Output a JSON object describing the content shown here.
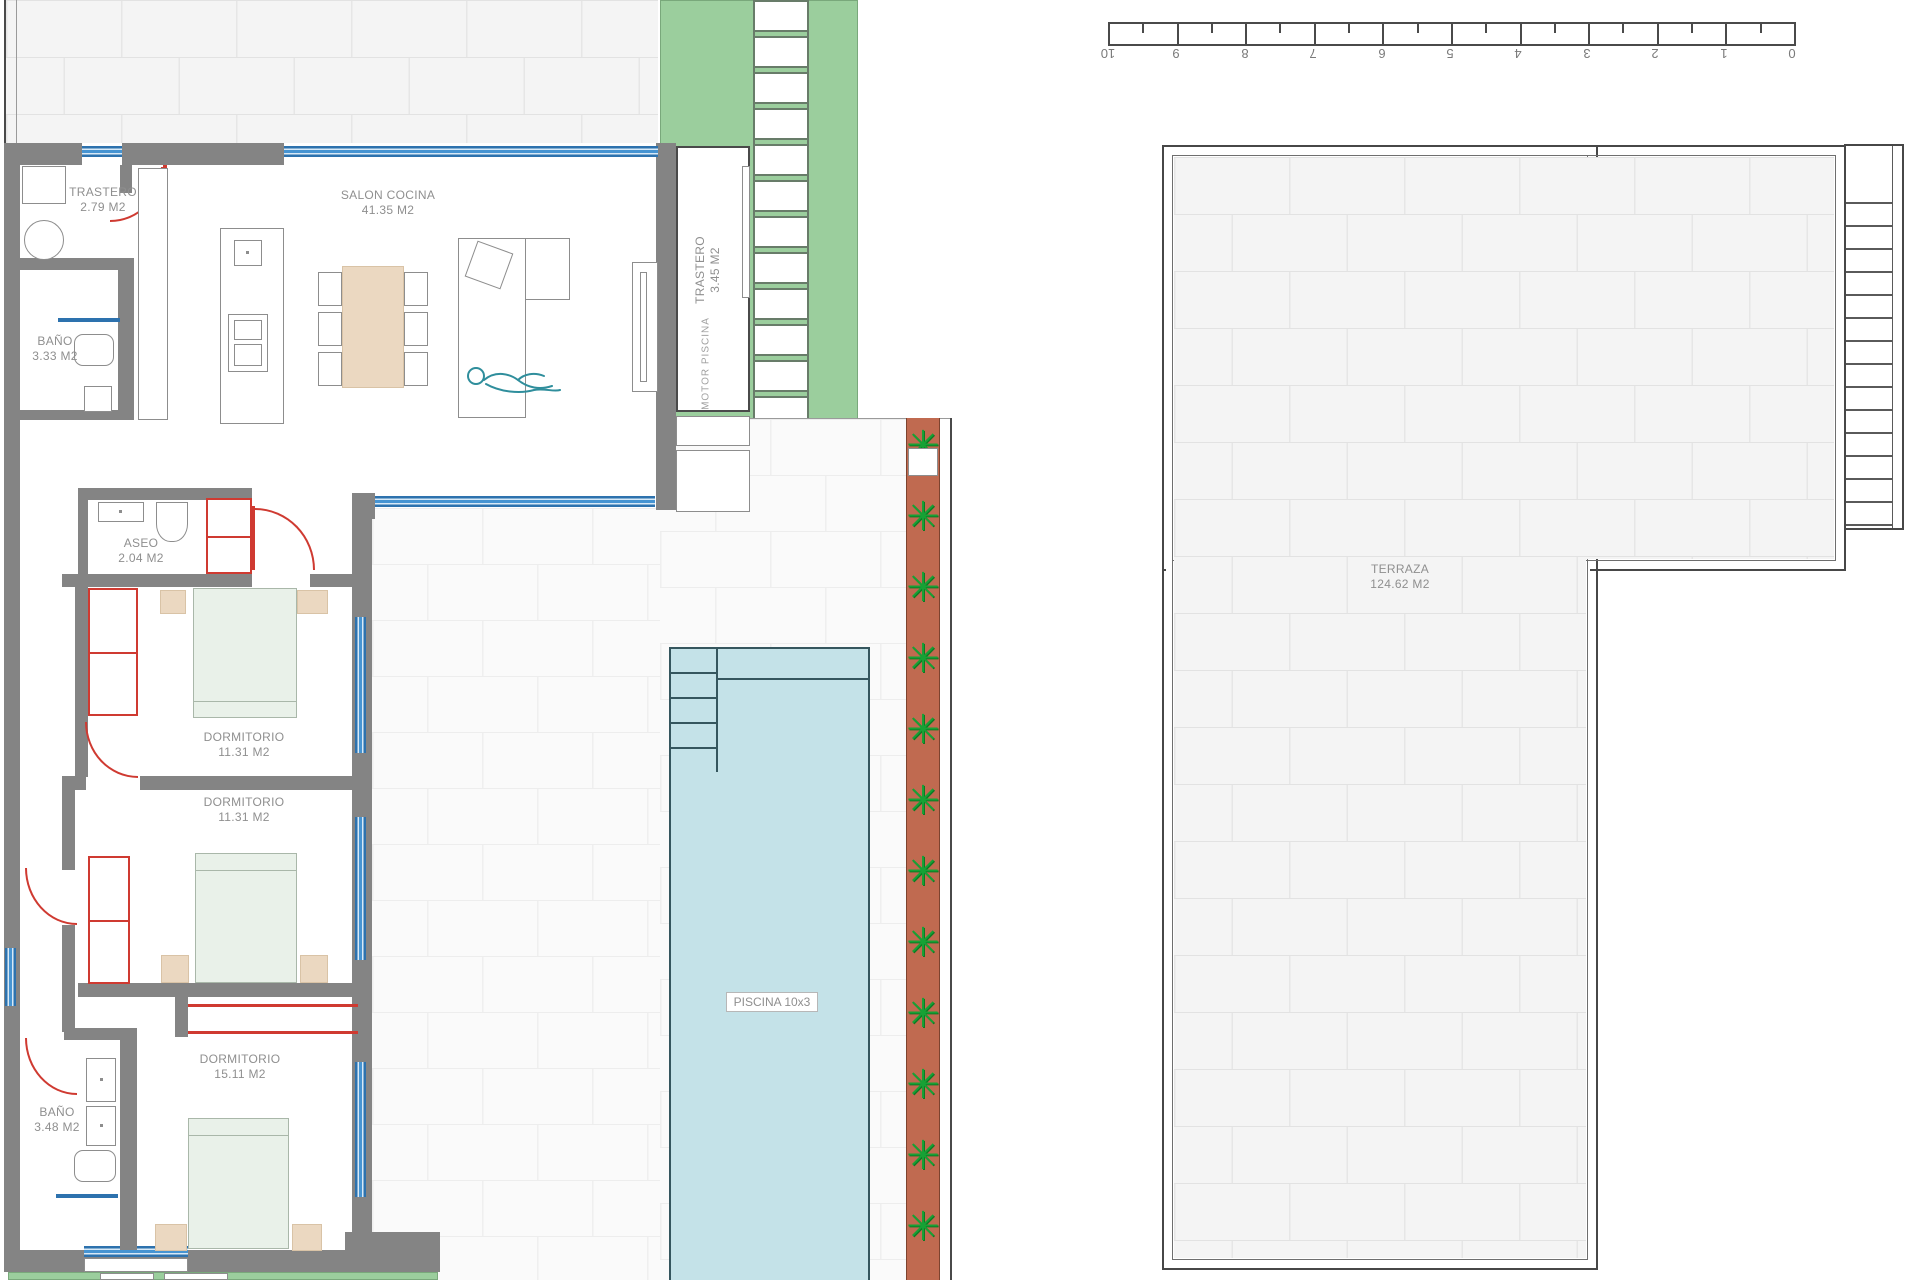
{
  "plan": {
    "rooms": [
      {
        "name": "TRASTERO",
        "area": "2.79 M2"
      },
      {
        "name": "SALON COCINA",
        "area": "41.35 M2"
      },
      {
        "name": "BAÑO",
        "area": "3.33 M2"
      },
      {
        "name": "TRASTERO",
        "area": "3.45 M2"
      },
      {
        "name": "ASEO",
        "area": "2.04 M2"
      },
      {
        "name": "DORMITORIO",
        "area": "11.31 M2"
      },
      {
        "name": "DORMITORIO",
        "area": "11.31 M2"
      },
      {
        "name": "DORMITORIO",
        "area": "15.11 M2"
      },
      {
        "name": "BAÑO",
        "area": "3.48 M2"
      },
      {
        "name": "TERRAZA",
        "area": "124.62 M2"
      }
    ],
    "pool_label": "PISCINA 10x3",
    "motor_label": "MOTOR  PISCINA"
  },
  "ruler": {
    "labels": [
      "10",
      "9",
      "8",
      "7",
      "6",
      "5",
      "4",
      "3",
      "2",
      "1",
      "0"
    ]
  },
  "icons": {
    "plant": "✳"
  },
  "colors": {
    "wall_gray": "#848484",
    "window_blue": "#2d72ae",
    "door_red": "#cf3a31",
    "pool_blue": "#c4e2e8",
    "garden_green": "#9bce9d",
    "planter_terracotta": "#c06a50",
    "plant_green": "#17a135",
    "bed_green": "#e9f1e9",
    "furniture_tan": "#ebd8c1",
    "label_gray": "#8f8f8f"
  }
}
